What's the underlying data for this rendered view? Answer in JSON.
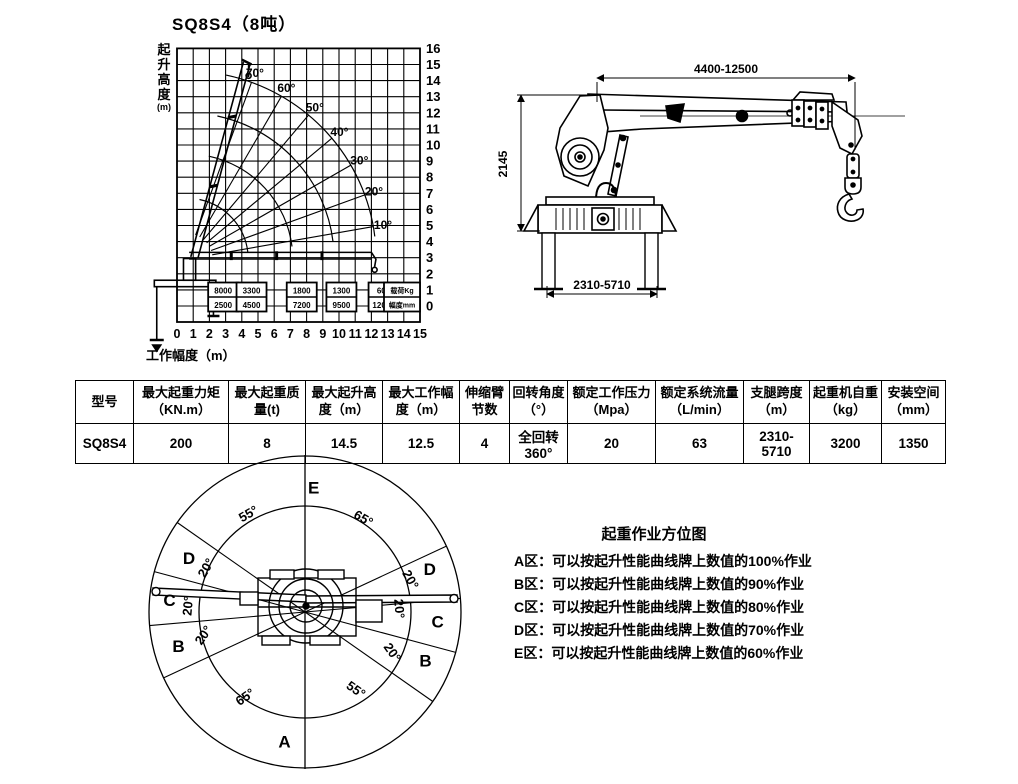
{
  "colors": {
    "ink": "#000000",
    "bg": "#ffffff"
  },
  "load_chart": {
    "title": "SQ8S4（8吨）",
    "ylabel_chars": [
      "起",
      "升",
      "高",
      "度",
      "(m)"
    ],
    "xlabel": "工作幅度（m）"
  },
  "chart_data": {
    "type": "line",
    "title": "SQ8S4（8吨）",
    "xlabel": "工作幅度（m）",
    "ylabel": "起升高度(m)",
    "xlim": [
      0,
      15
    ],
    "ylim": [
      0,
      16
    ],
    "grid": "on",
    "xticks": [
      0,
      1,
      2,
      3,
      4,
      5,
      6,
      7,
      8,
      9,
      10,
      11,
      12,
      13,
      14,
      15
    ],
    "yticks": [
      0,
      1,
      2,
      3,
      4,
      5,
      6,
      7,
      8,
      9,
      10,
      11,
      12,
      13,
      14,
      15,
      16
    ],
    "boom_angle_lines_deg": [
      10,
      20,
      30,
      40,
      50,
      60,
      70
    ],
    "angle_labels": [
      "10°",
      "20°",
      "30°",
      "40°",
      "50°",
      "60°",
      "70°"
    ],
    "reach_arcs_m": [
      3.8,
      6.55,
      9.1,
      11.7
    ],
    "pivot_m": {
      "x": 0.6,
      "y": 2.9
    },
    "load_labels": {
      "col_load": "载荷Kg",
      "col_radius": "幅度mm",
      "points": [
        {
          "load_kg": 8000,
          "radius_mm": 2500
        },
        {
          "load_kg": 3300,
          "radius_mm": 4500
        },
        {
          "load_kg": 1800,
          "radius_mm": 7200
        },
        {
          "load_kg": 1300,
          "radius_mm": 9500
        },
        {
          "load_kg": 600,
          "radius_mm": 12000
        }
      ]
    }
  },
  "side_view": {
    "dim_boom_length": "4400-12500",
    "dim_height": "2145",
    "dim_outrigger": "2310-5710"
  },
  "spec_table": {
    "headers": [
      "型号",
      "最大起重力矩\n（KN.m）",
      "最大起重质\n量(t)",
      "最大起升高\n度（m）",
      "最大工作幅\n度（m）",
      "伸缩臂\n节数",
      "回转角度\n（°）",
      "额定工作压力\n（Mpa）",
      "额定系统流量\n（L/min）",
      "支腿跨度\n（m）",
      "起重机自重\n（kg）",
      "安装空间\n（mm）"
    ],
    "row": [
      "SQ8S4",
      "200",
      "8",
      "14.5",
      "12.5",
      "4",
      "全回转\n360°",
      "20",
      "63",
      "2310-5710",
      "3200",
      "1350"
    ]
  },
  "zones": {
    "legend_title": "起重作业方位图",
    "notes": [
      "A区：可以按起升性能曲线牌上数值的100%作业",
      "B区：可以按起升性能曲线牌上数值的90%作业",
      "C区：可以按起升性能曲线牌上数值的80%作业",
      "D区：可以按起升性能曲线牌上数值的70%作业",
      "E区：可以按起升性能曲线牌上数值的60%作业"
    ],
    "diagram": {
      "outer_r": 156,
      "inner_r": 106,
      "boundaries_deg": [
        -55,
        -75,
        -95,
        -115,
        65,
        85,
        105,
        125
      ],
      "zone_labels": [
        {
          "text": "E",
          "az": 4,
          "r": 125
        },
        {
          "text": "D",
          "az": -65,
          "r": 128
        },
        {
          "text": "C",
          "az": -85,
          "r": 136
        },
        {
          "text": "B",
          "az": -105,
          "r": 131
        },
        {
          "text": "A",
          "az": -171,
          "r": 131
        },
        {
          "text": "D",
          "az": 71,
          "r": 132
        },
        {
          "text": "C",
          "az": 94,
          "r": 133
        },
        {
          "text": "B",
          "az": 112,
          "r": 130
        }
      ],
      "angle_labels": [
        {
          "text": "55°",
          "az": -30,
          "r": 113,
          "rot": -30
        },
        {
          "text": "65°",
          "az": 32,
          "r": 110,
          "rot": 30
        },
        {
          "text": "20°",
          "az": -66,
          "r": 108,
          "rot": -60
        },
        {
          "text": "20°",
          "az": -87,
          "r": 117,
          "rot": -85
        },
        {
          "text": "20°",
          "az": -103,
          "r": 104,
          "rot": -55
        },
        {
          "text": "20°",
          "az": 73,
          "r": 110,
          "rot": 60
        },
        {
          "text": "20°",
          "az": 88,
          "r": 94,
          "rot": 85
        },
        {
          "text": "20°",
          "az": 115,
          "r": 96,
          "rot": 55
        },
        {
          "text": "65°",
          "az": -145,
          "r": 104,
          "rot": -35
        },
        {
          "text": "55°",
          "az": 147,
          "r": 93,
          "rot": 35
        }
      ]
    }
  }
}
